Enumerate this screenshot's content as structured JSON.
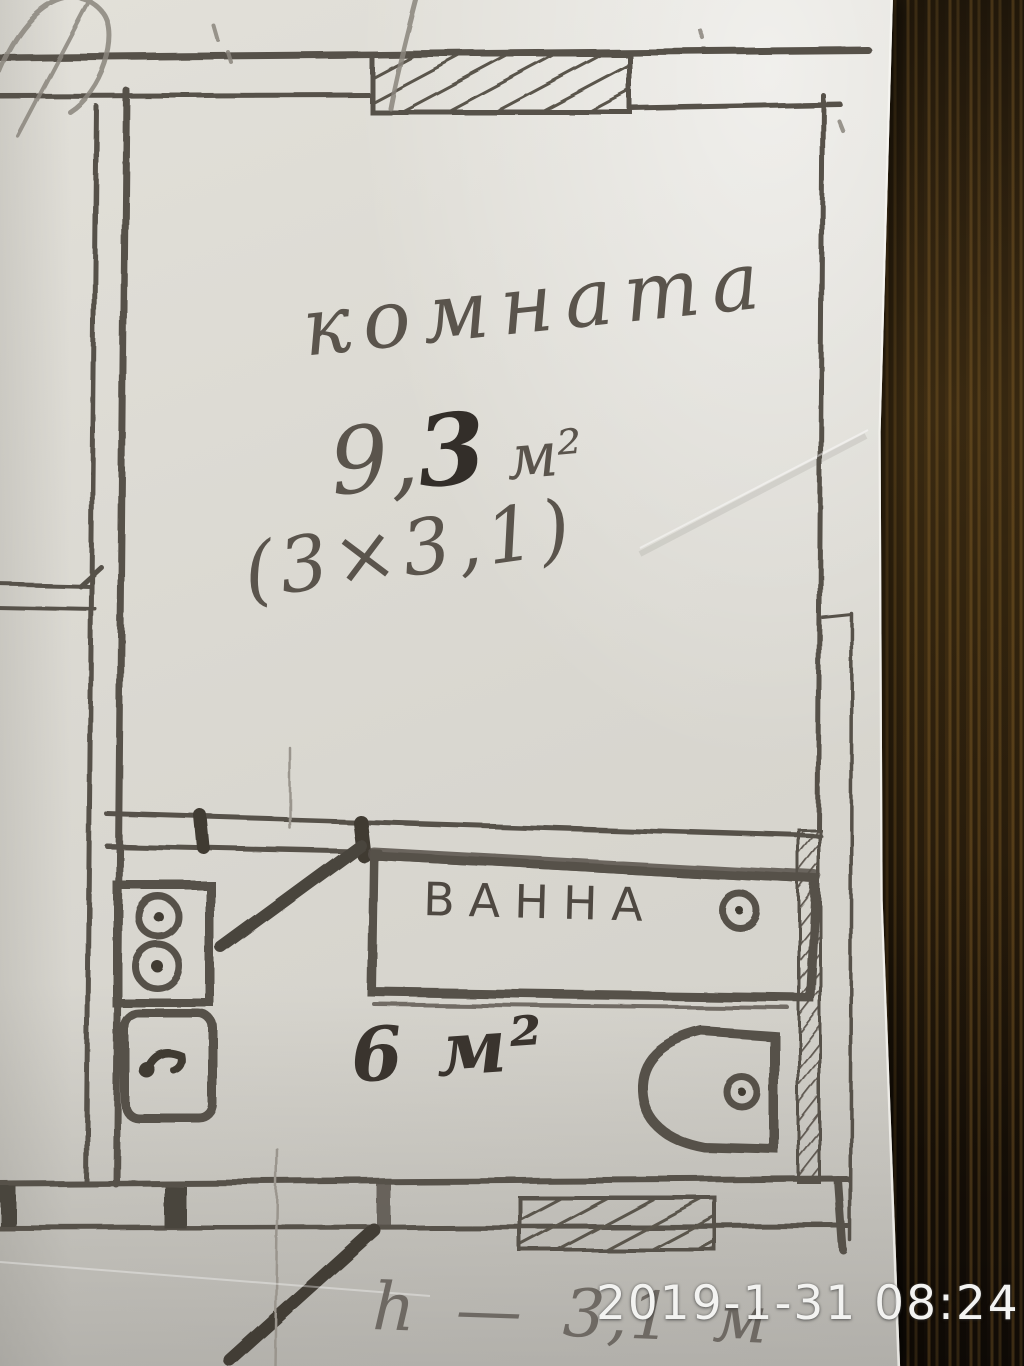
{
  "photo": {
    "timestamp": "2019-1-31 08:24"
  },
  "plan": {
    "room": {
      "name": "комната",
      "area_main": "9,",
      "area_bold": "3",
      "area_unit": "м²",
      "dimensions": "(3×3,1)"
    },
    "bathroom": {
      "tub_label": "ВАННА",
      "area": "6 м²"
    },
    "note_height": "h — 3,1 м"
  },
  "colors": {
    "ink": "#57514a",
    "ink_dark": "#3f3a33",
    "pencil": "#8a857d",
    "paper": "#dbd9d2",
    "wood_dark": "#1b1208",
    "wood_light": "#6b4e22",
    "timestamp_text": "#f3f3f1"
  }
}
